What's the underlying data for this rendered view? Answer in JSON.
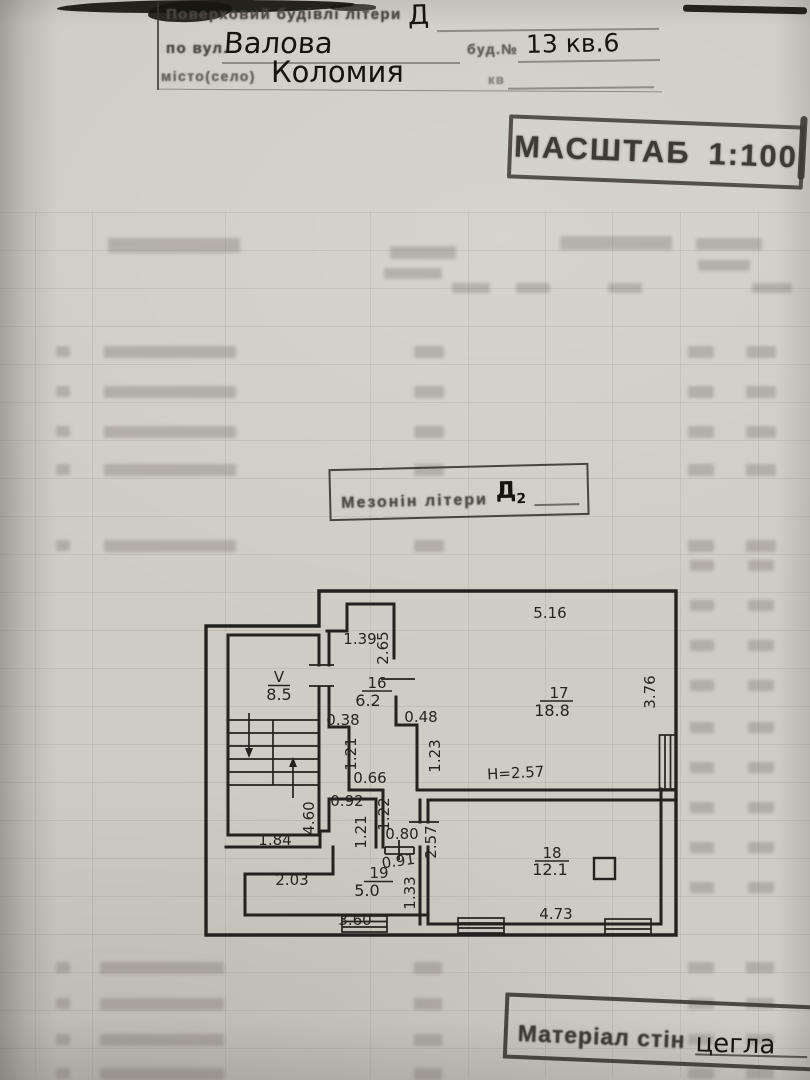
{
  "form": {
    "line1_label": "Поверховий будівлі літери",
    "line1_value": "Д",
    "line2_prefix": "по вул.",
    "line2_street": "Валова",
    "line2_house_label": "буд.№",
    "line2_house_value": "13 кв.6",
    "line3_label": "місто(село)",
    "line3_city": "Коломия",
    "line3_apt_label": "кв"
  },
  "scale_stamp": {
    "word": "МАСШТАБ",
    "ratio": "1:100"
  },
  "material_stamp": {
    "label": "Матеріал стін",
    "value": "цегла"
  },
  "plan": {
    "title_label": "Мезонін літери",
    "title_letter": "Д",
    "title_letter_sub": "2",
    "rooms": [
      {
        "number": "V",
        "area": "8.5"
      },
      {
        "number": "16",
        "area": "6.2"
      },
      {
        "number": "17",
        "area": "18.8"
      },
      {
        "number": "18",
        "area": "12.1"
      },
      {
        "number": "19",
        "area": "5.0"
      }
    ],
    "dimensions": [
      {
        "t": "5.16",
        "x": 548,
        "y": 616,
        "r": 0
      },
      {
        "t": "3.76",
        "x": 653,
        "y": 690,
        "r": -90
      },
      {
        "t": "1.39",
        "x": 358,
        "y": 642,
        "r": 0
      },
      {
        "t": "2.65",
        "x": 386,
        "y": 646,
        "r": -90
      },
      {
        "t": "0.38",
        "x": 341,
        "y": 723,
        "r": 0
      },
      {
        "t": "0.48",
        "x": 419,
        "y": 720,
        "r": 0
      },
      {
        "t": "1.21",
        "x": 354,
        "y": 752,
        "r": -90
      },
      {
        "t": "1.23",
        "x": 438,
        "y": 754,
        "r": -90
      },
      {
        "t": "0.66",
        "x": 368,
        "y": 781,
        "r": 0
      },
      {
        "t": "H=2.57",
        "x": 514,
        "y": 776,
        "r": -3,
        "fs": 18
      },
      {
        "t": "0.92",
        "x": 345,
        "y": 804,
        "r": 0
      },
      {
        "t": "4.60",
        "x": 312,
        "y": 816,
        "r": -90
      },
      {
        "t": "1.22",
        "x": 387,
        "y": 812,
        "r": -90
      },
      {
        "t": "1.21",
        "x": 364,
        "y": 830,
        "r": -90
      },
      {
        "t": "0.80",
        "x": 400,
        "y": 837,
        "r": 0
      },
      {
        "t": "2.57",
        "x": 434,
        "y": 840,
        "r": -90
      },
      {
        "t": "0.91",
        "x": 397,
        "y": 864,
        "r": -8
      },
      {
        "t": "1.84",
        "x": 273,
        "y": 843,
        "r": 0
      },
      {
        "t": "2.03",
        "x": 290,
        "y": 883,
        "r": 0
      },
      {
        "t": "1.33",
        "x": 413,
        "y": 891,
        "r": -90
      },
      {
        "t": "3.60",
        "x": 353,
        "y": 923,
        "r": 0
      },
      {
        "t": "4.73",
        "x": 554,
        "y": 917,
        "r": 0
      }
    ]
  },
  "colors": {
    "paper": "#cfccc5",
    "ink": "#24221e",
    "stamp_ink": "#3d3933",
    "handwriting": "#17140f"
  }
}
